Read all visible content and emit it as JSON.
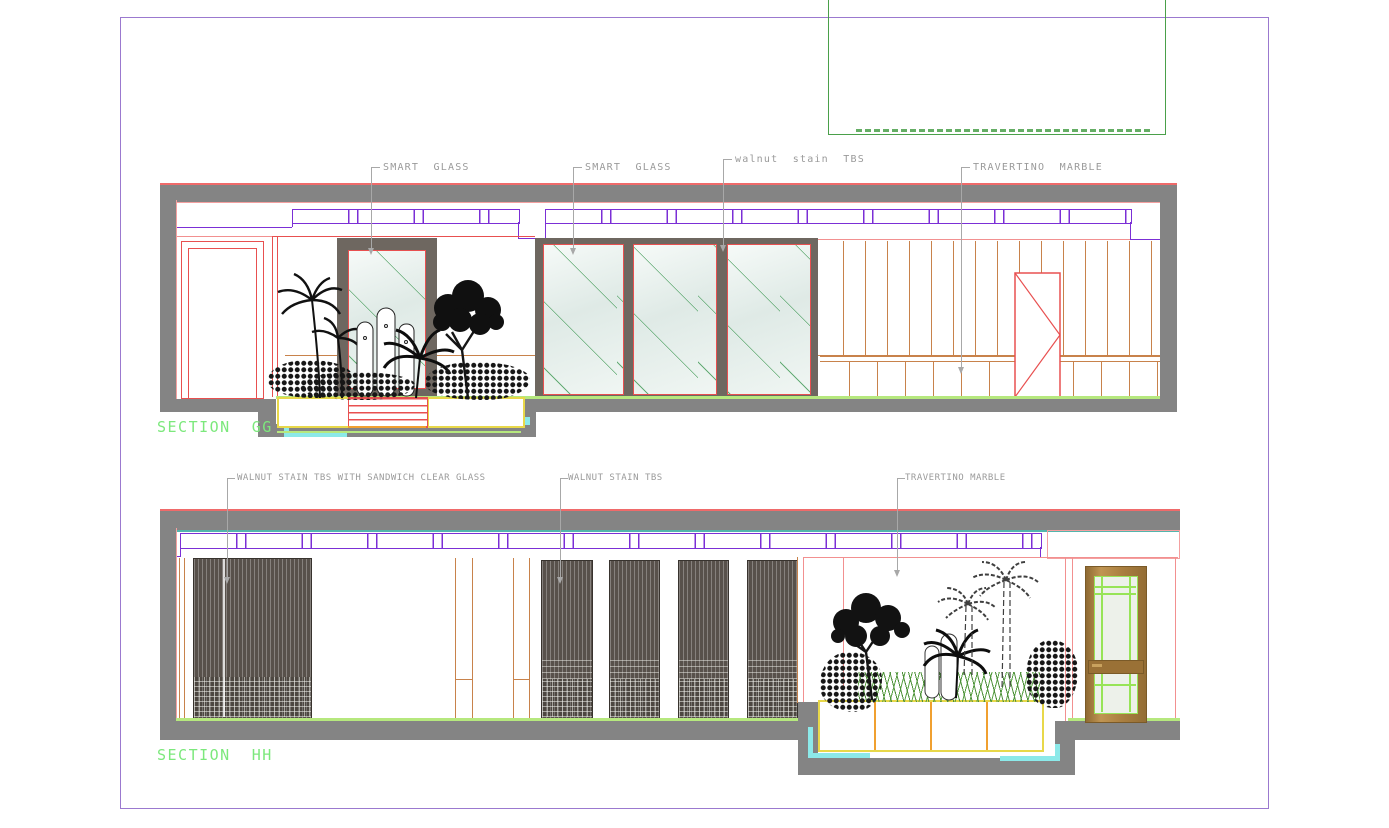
{
  "palette": {
    "frame_purple": "#9b79cf",
    "ceiling_purple": "#7b2fd6",
    "slab_gray": "#848484",
    "line_red": "#e85050",
    "line_salmon": "#f29090",
    "line_orange": "#c8824b",
    "glass_green": "#55a468",
    "floor_green": "#b6e87e",
    "accent_cyan": "#8ce9e9",
    "planter_yellow": "#e8d84a",
    "planter_orange": "#f0a030",
    "walnut_dark": "#58514b",
    "door_brown": "#ab7e41",
    "door_green": "#97e457",
    "text_green": "#7ce87c",
    "label_gray": "#9a9a9a",
    "ref_green": "#4aa04a"
  },
  "gg": {
    "title": "SECTION  GG",
    "labels": {
      "smart_glass_1": "SMART  GLASS",
      "smart_glass_2": "SMART  GLASS",
      "walnut": "walnut  stain  TBS",
      "travertino": "TRAVERTINO  MARBLE"
    }
  },
  "hh": {
    "title": "SECTION  HH",
    "labels": {
      "walnut_sandwich": "WALNUT STAIN TBS WITH SANDWICH CLEAR GLASS",
      "walnut": "WALNUT STAIN TBS",
      "travertino": "TRAVERTINO MARBLE"
    }
  }
}
